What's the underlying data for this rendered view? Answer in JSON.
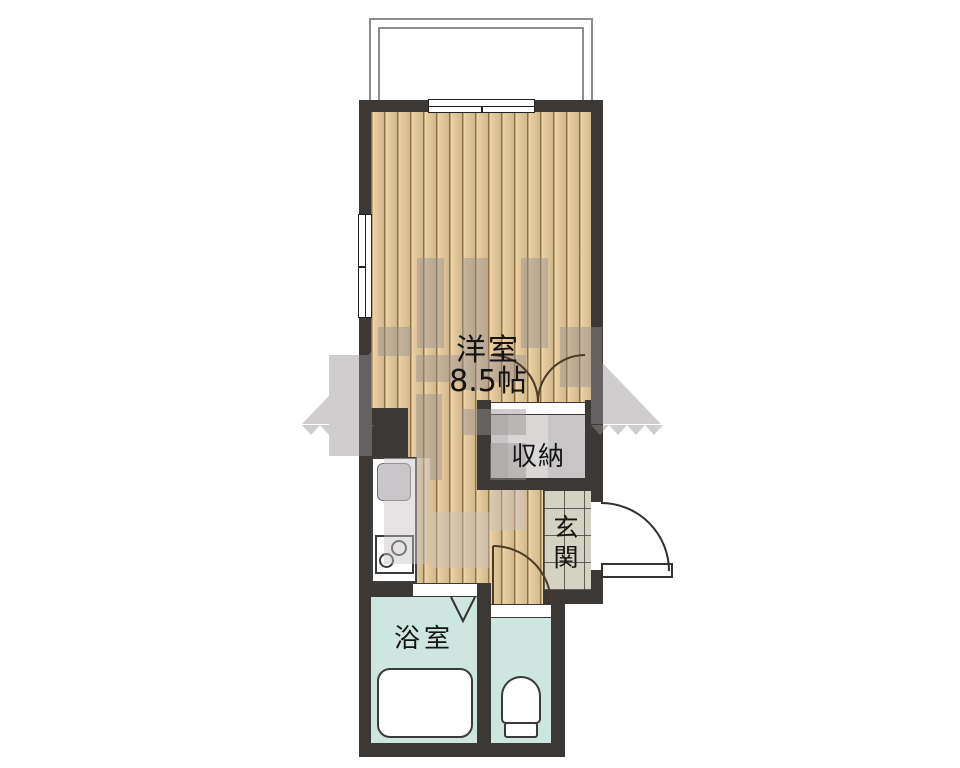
{
  "plan": {
    "type": "apartment-floor-plan",
    "labels": {
      "western_room": "洋室",
      "western_room_size": "8.5帖",
      "closet": "収納",
      "entrance": "玄関",
      "bathroom": "浴室"
    },
    "fixtures": {
      "balcony": "balcony-outline",
      "bathtub": "bathtub",
      "toilet": "toilet-top-view",
      "kitchen_sink": "kitchen-sink",
      "stove": "two-burner-stove",
      "windows": [
        "top-sliding-window",
        "left-sliding-window"
      ],
      "doors": [
        "entrance-swing-door",
        "closet-double-doors",
        "toilet-swing-door",
        "bathroom-folding-door"
      ],
      "watermark": "company-logo-watermark"
    },
    "colors": {
      "wall": "#3b3835",
      "wood_floor": "#e7cb9d",
      "wet_area": "#cde6df",
      "entrance_tile": "#d4d2c2",
      "closet_interior": "#c7c5c5",
      "sink": "#c8c8cc",
      "watermark": "#9b9797",
      "balcony_line": "#8d8d8d",
      "background": "#ffffff"
    }
  }
}
